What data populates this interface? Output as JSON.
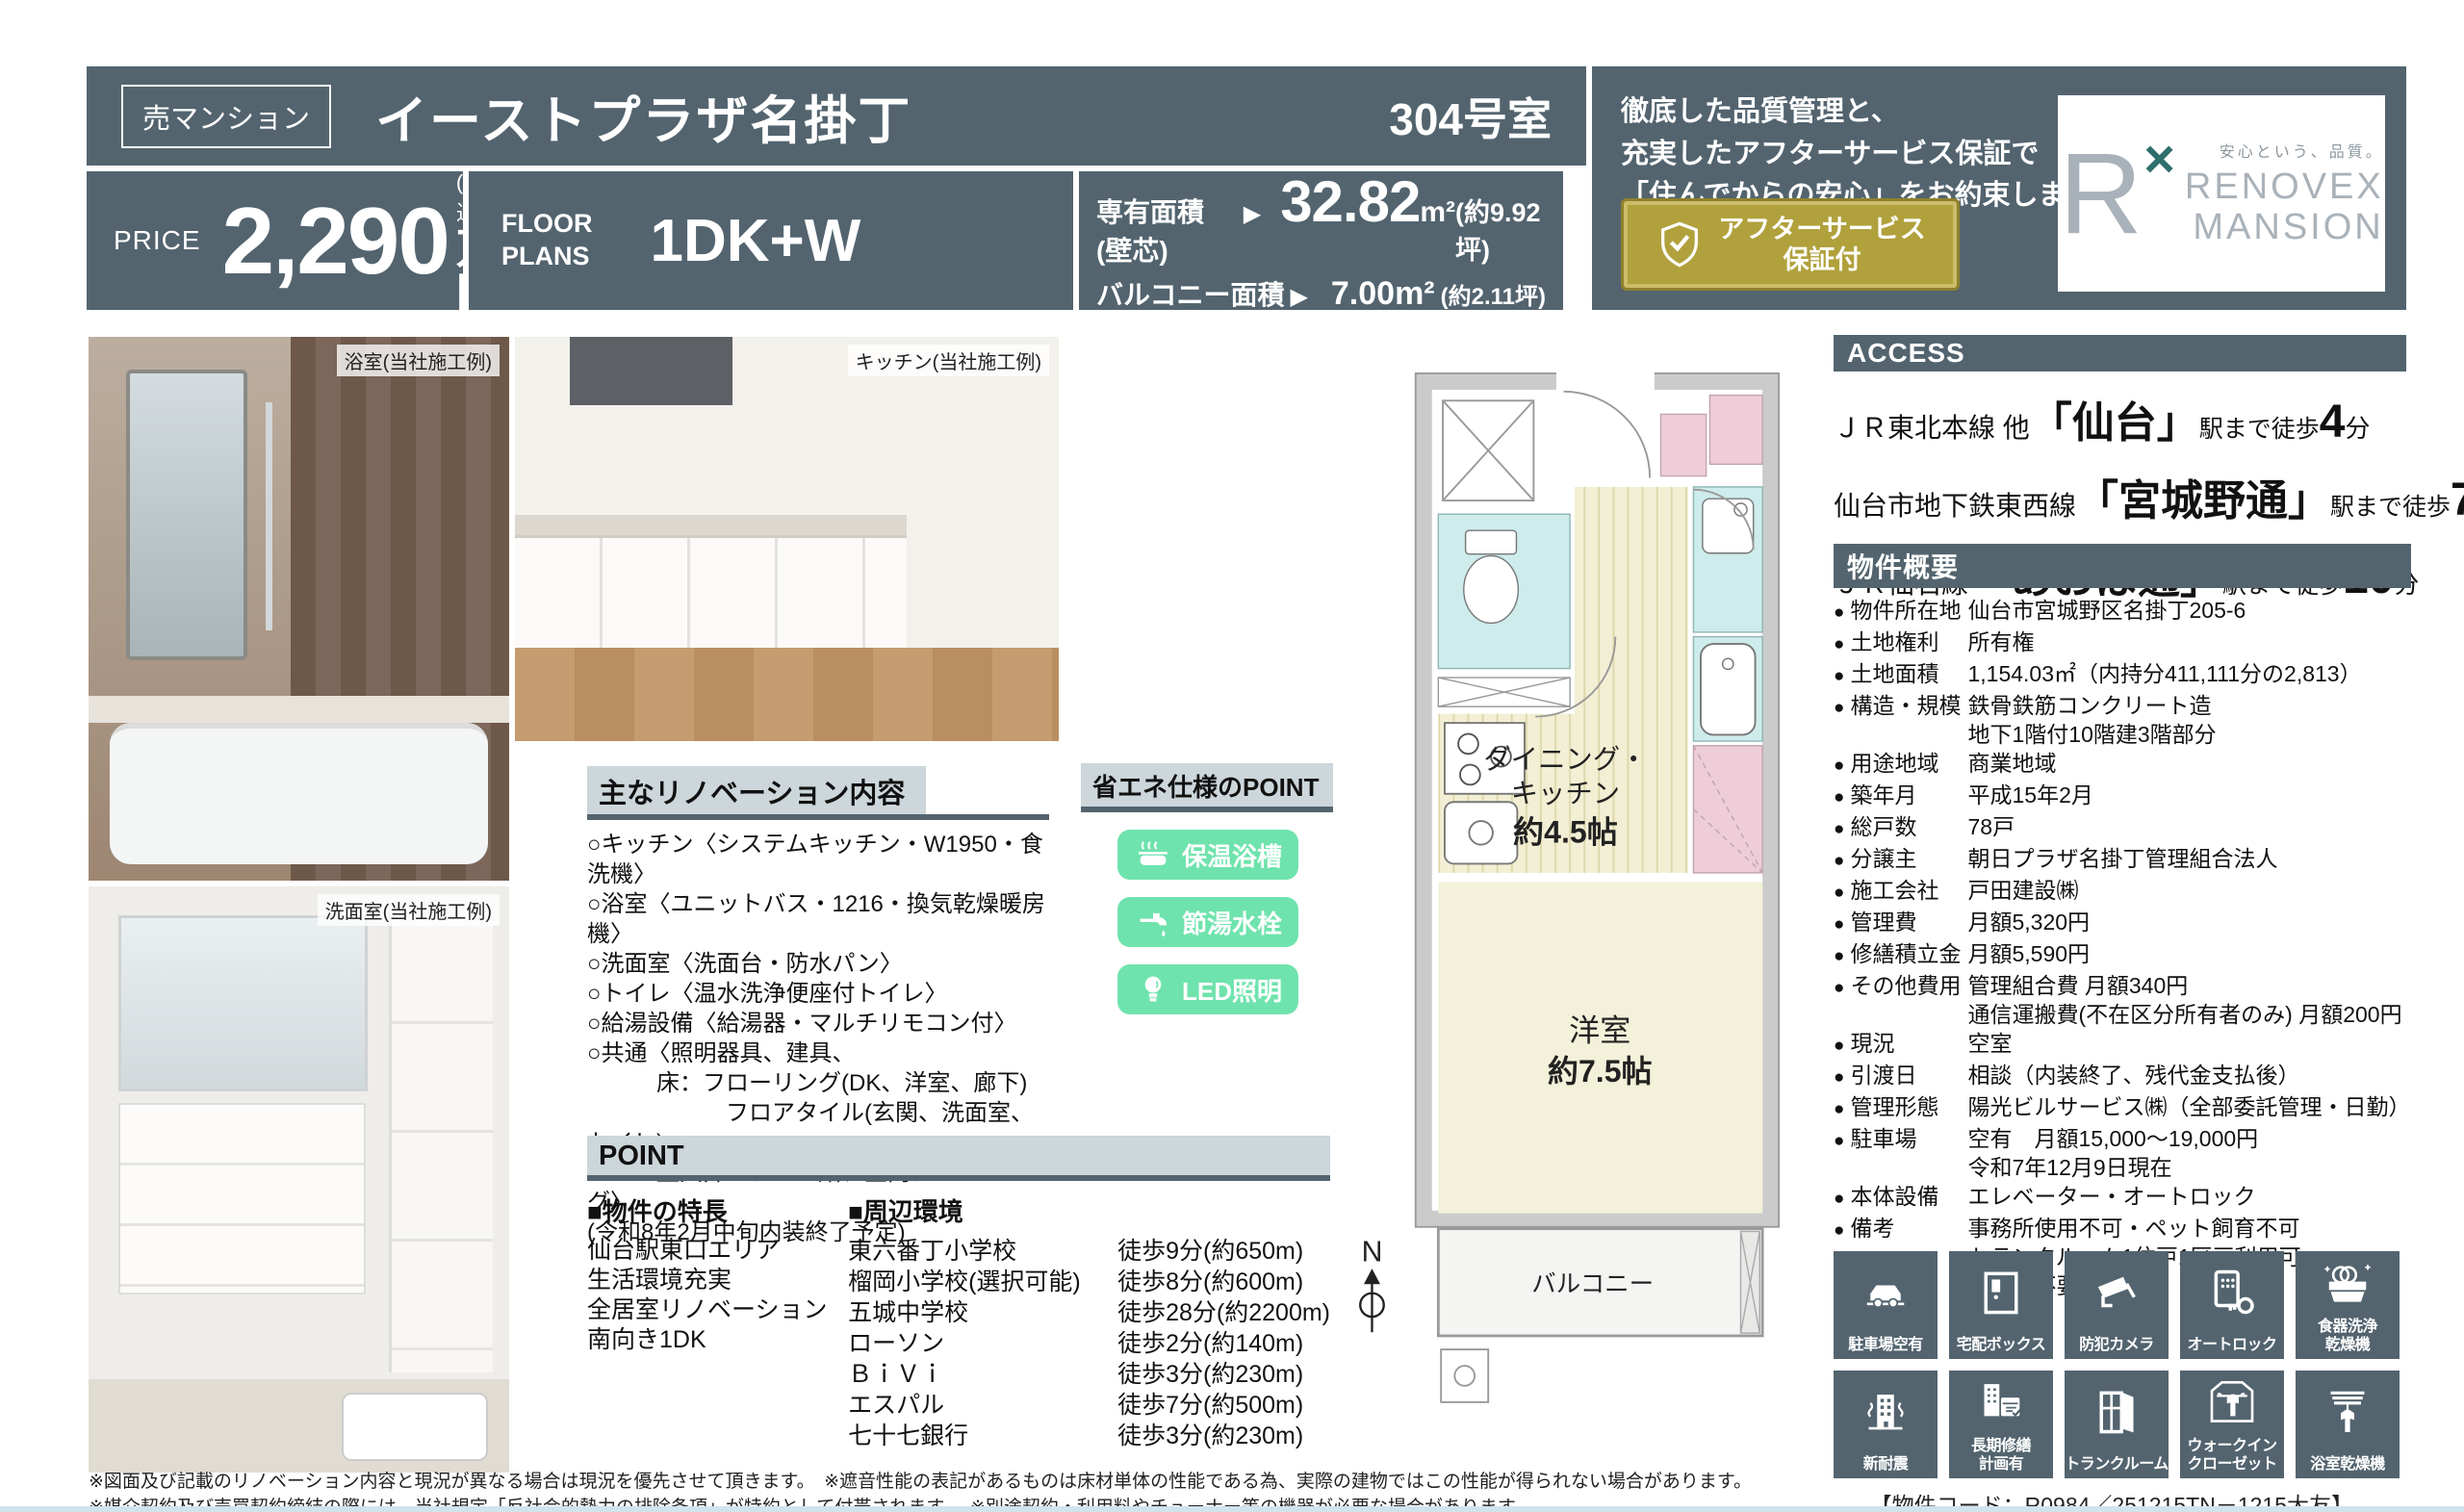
{
  "header": {
    "badge": "売マンション",
    "title": "イーストプラザ名掛丁",
    "room": "304号室"
  },
  "price": {
    "label": "PRICE",
    "amount": "2,290",
    "tax": "(税込)",
    "unit": "万円"
  },
  "floor_plan": {
    "label1": "FLOOR",
    "label2": "PLANS",
    "value": "1DK+W"
  },
  "areas": {
    "senyu_label": "専有面積 (壁芯)",
    "arrow": "▶",
    "senyu_value": "32.82",
    "senyu_unit": "m²",
    "senyu_tsubo": "(約9.92坪)",
    "balcony_label": "バルコニー面積",
    "balcony_value": "7.00m²",
    "balcony_tsubo": "(約2.11坪)"
  },
  "promo": {
    "line1": "徹底した品質管理と、",
    "line2": "充実したアフターサービス保証で",
    "line3": "「住んでからの安心」をお約束します。",
    "badge_line1": "アフターサービス",
    "badge_line2": "保証付"
  },
  "logo": {
    "mark": "R",
    "x": "×",
    "tagline": "安心という、品質。",
    "name1": "RENOVEX",
    "name2": "MANSION"
  },
  "photos": [
    {
      "caption": "浴室(当社施工例)"
    },
    {
      "caption": "キッチン(当社施工例)"
    },
    {
      "caption": "洗面室(当社施工例)"
    }
  ],
  "renovation": {
    "title": "主なリノベーション内容",
    "lines": [
      "○キッチン〈システムキッチン・W1950・食洗機〉",
      "○浴室〈ユニットバス・1216・換気乾燥暖房機〉",
      "○洗面室〈洗面台・防水パン〉",
      "○トイレ〈温水洗浄便座付トイレ〉",
      "○給湯設備〈給湯器・マルチリモコン付〉",
      "○共通〈照明器具、建具、",
      "　　　床：フローリング(DK、洋室、廊下)",
      "　　　　　　フロアタイル(玄関、洗面室、トイレ)",
      "　　　壁天井：クロス貼、室内クリーニング〉",
      "(令和8年2月中旬内装終了予定)"
    ]
  },
  "eco": {
    "title": "省エネ仕様のPOINT",
    "badges": [
      "保温浴槽",
      "節湯水栓",
      "LED照明"
    ]
  },
  "point": {
    "title": "POINT",
    "features_title": "■物件の特長",
    "features": [
      "仙台駅東口エリア",
      "生活環境充実",
      "全居室リノベーション",
      "南向き1DK"
    ],
    "surroundings_title": "■周辺環境",
    "surroundings": [
      {
        "name": "東六番丁小学校",
        "distance": "徒歩9分(約650m)"
      },
      {
        "name": "榴岡小学校(選択可能)",
        "distance": "徒歩8分(約600m)"
      },
      {
        "name": "五城中学校",
        "distance": "徒歩28分(約2200m)"
      },
      {
        "name": "ローソン",
        "distance": "徒歩2分(約140m)"
      },
      {
        "name": "ＢｉＶｉ",
        "distance": "徒歩3分(約230m)"
      },
      {
        "name": "エスパル",
        "distance": "徒歩7分(約500m)"
      },
      {
        "name": "七十七銀行",
        "distance": "徒歩3分(約230m)"
      }
    ]
  },
  "floorplan": {
    "dk1": "ダイニング・",
    "dk2": "キッチン",
    "dk3": "約4.5帖",
    "room1": "洋室",
    "room2": "約7.5帖",
    "balcony": "バルコニー",
    "compass": "N"
  },
  "access": {
    "title": "ACCESS",
    "lines": [
      {
        "prefix": "ＪＲ東北本線 他",
        "station": "「仙台」",
        "mid": "駅まで徒歩",
        "min": "4",
        "suffix": "分"
      },
      {
        "prefix": "仙台市地下鉄東西線",
        "station": "「宮城野通」",
        "mid": "駅まで徒歩",
        "min": "7",
        "suffix": "分"
      },
      {
        "prefix": "ＪＲ仙石線",
        "station": "「あおば通」",
        "mid": "駅まで徒歩",
        "min": "10",
        "suffix": "分"
      }
    ]
  },
  "overview": {
    "title": "物件概要",
    "bullet": "●",
    "rows": [
      {
        "label": "物件所在地",
        "lines": [
          "仙台市宮城野区名掛丁205-6"
        ]
      },
      {
        "label": "土地権利",
        "lines": [
          "所有権"
        ]
      },
      {
        "label": "土地面積",
        "lines": [
          "1,154.03㎡（内持分411,111分の2,813）"
        ]
      },
      {
        "label": "構造・規模",
        "lines": [
          "鉄骨鉄筋コンクリート造",
          "地下1階付10階建3階部分"
        ]
      },
      {
        "label": "用途地域",
        "lines": [
          "商業地域"
        ]
      },
      {
        "label": "築年月",
        "lines": [
          "平成15年2月"
        ]
      },
      {
        "label": "総戸数",
        "lines": [
          "78戸"
        ]
      },
      {
        "label": "分譲主",
        "lines": [
          "朝日プラザ名掛丁管理組合法人"
        ]
      },
      {
        "label": "施工会社",
        "lines": [
          "戸田建設㈱"
        ]
      },
      {
        "label": "管理費",
        "lines": [
          "月額5,320円"
        ]
      },
      {
        "label": "修繕積立金",
        "lines": [
          "月額5,590円"
        ]
      },
      {
        "label": "その他費用",
        "lines": [
          "管理組合費 月額340円",
          "通信運搬費(不在区分所有者のみ) 月額200円"
        ]
      },
      {
        "label": "現況",
        "lines": [
          "空室"
        ]
      },
      {
        "label": "引渡日",
        "lines": [
          "相談（内装終了、残代金支払後）"
        ]
      },
      {
        "label": "管理形態",
        "lines": [
          "陽光ビルサービス㈱（全部委託管理・日勤）"
        ]
      },
      {
        "label": "駐車場",
        "lines": [
          "空有　月額15,000〜19,000円",
          "令和7年12月9日現在"
        ]
      },
      {
        "label": "本体設備",
        "lines": [
          "エレベーター・オートロック"
        ]
      },
      {
        "label": "備考",
        "lines": [
          "事務所使用不可・ペット飼育不可",
          "トランクルーム1住戸1区画利用可",
          "使用料不要　No.14　1階"
        ]
      }
    ]
  },
  "amenities": [
    "駐車場空有",
    "宅配ボックス",
    "防犯カメラ",
    "オートロック",
    "食器洗浄\n乾燥機",
    "新耐震",
    "長期修繕\n計画有",
    "トランクルーム",
    "ウォークイン\nクローゼット",
    "浴室乾燥機"
  ],
  "footer": {
    "line1": "※図面及び記載のリノベーション内容と現況が異なる場合は現況を優先させて頂きます。　※遮音性能の表記があるものは床材単体の性能である為、実際の建物ではこの性能が得られない場合があります。",
    "line2": "※媒介契約及び売買契約締結の際には、当社規定「反社会的勢力の排除条項」が特約として付帯されます。　※別途契約・利用料やチューナー等の機器が必要な場合があります。",
    "code": "【物件コード：R0984／251215TN－1215大友】"
  }
}
